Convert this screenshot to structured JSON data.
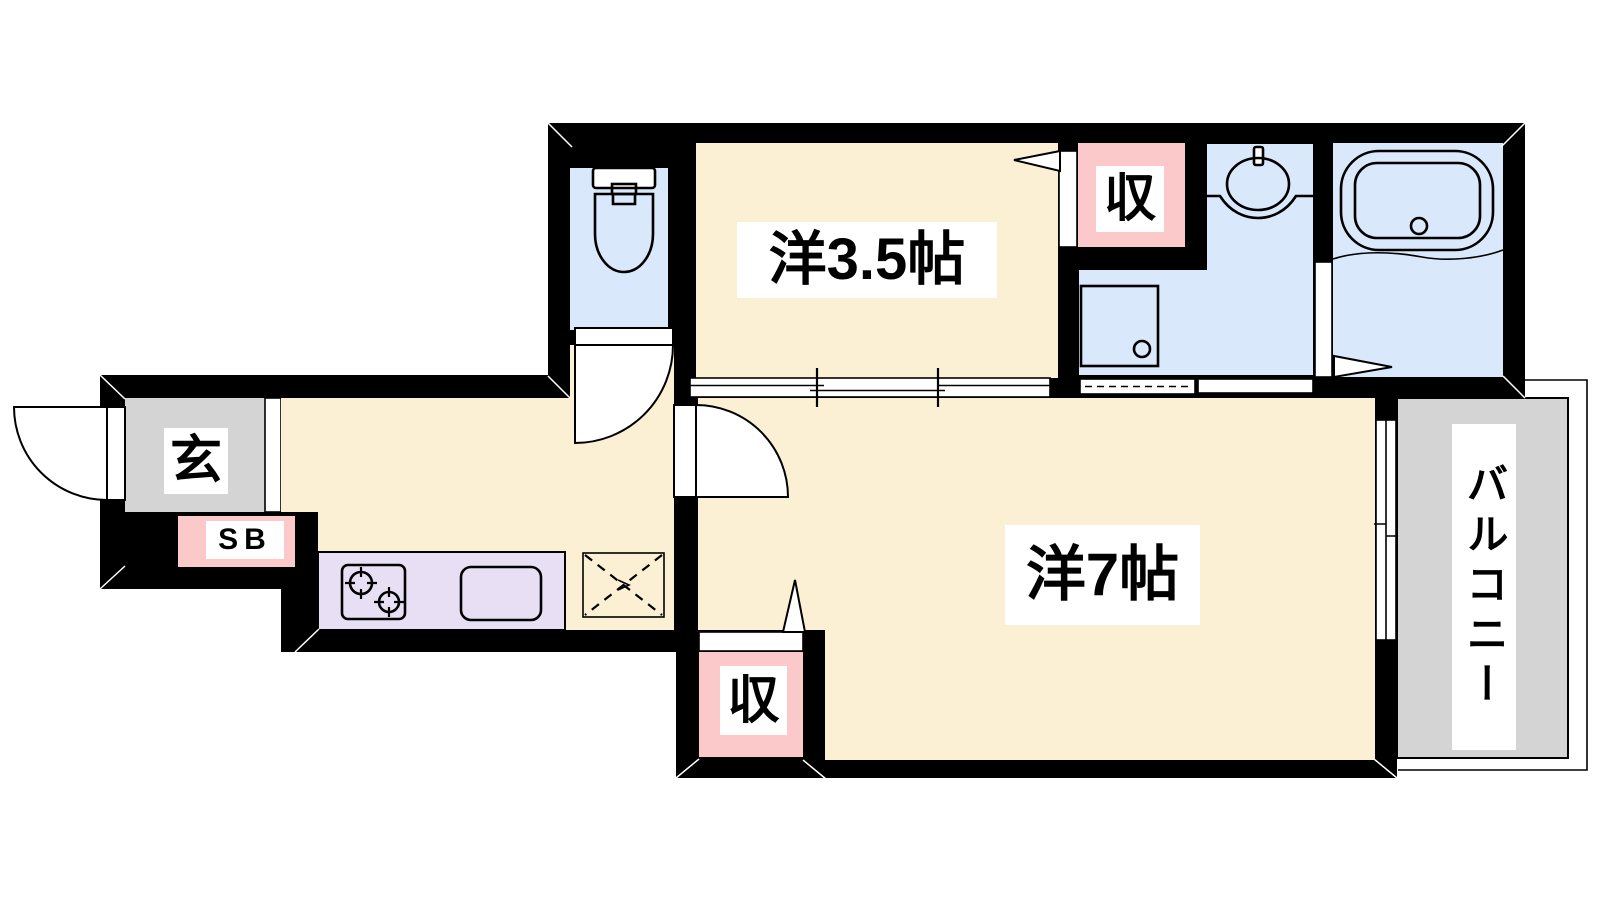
{
  "plan": {
    "type": "apartment-floorplan",
    "labels": {
      "room_3_5": "洋3.5帖",
      "room_7": "洋7帖",
      "closet_upper": "収",
      "closet_lower": "収",
      "entrance": "玄",
      "shoe_box": "SB",
      "balcony": "バルコニー"
    },
    "rooms": [
      {
        "name": "western-room-3.5-tatami",
        "label": "洋3.5帖"
      },
      {
        "name": "western-room-7-tatami",
        "label": "洋7帖"
      },
      {
        "name": "entrance",
        "label": "玄"
      },
      {
        "name": "shoe-box",
        "label": "SB"
      },
      {
        "name": "closet-upper",
        "label": "収"
      },
      {
        "name": "closet-lower",
        "label": "収"
      },
      {
        "name": "balcony",
        "label": "バルコニー"
      },
      {
        "name": "toilet-room",
        "label": ""
      },
      {
        "name": "washroom",
        "label": ""
      },
      {
        "name": "bathroom",
        "label": ""
      },
      {
        "name": "kitchen",
        "label": ""
      }
    ],
    "fixtures": [
      "toilet-icon",
      "washbasin-icon",
      "bathtub-icon",
      "washing-machine-pan-icon",
      "gas-stove-icon",
      "kitchen-sink-icon",
      "floor-access-hatch-icon",
      "door-swing-icon",
      "sliding-partition-icon",
      "folding-door-icon"
    ],
    "colors": {
      "wall": "#000000",
      "room_floor": "#FBEFD4",
      "wet_area_floor": "#D9E8FA",
      "closet_fill": "#FBC9C9",
      "kitchen_counter": "#E8DFF5",
      "entrance_floor": "#D4D4D4",
      "balcony_floor": "#D4D4D4",
      "label_background": "#FFFFFF"
    }
  }
}
